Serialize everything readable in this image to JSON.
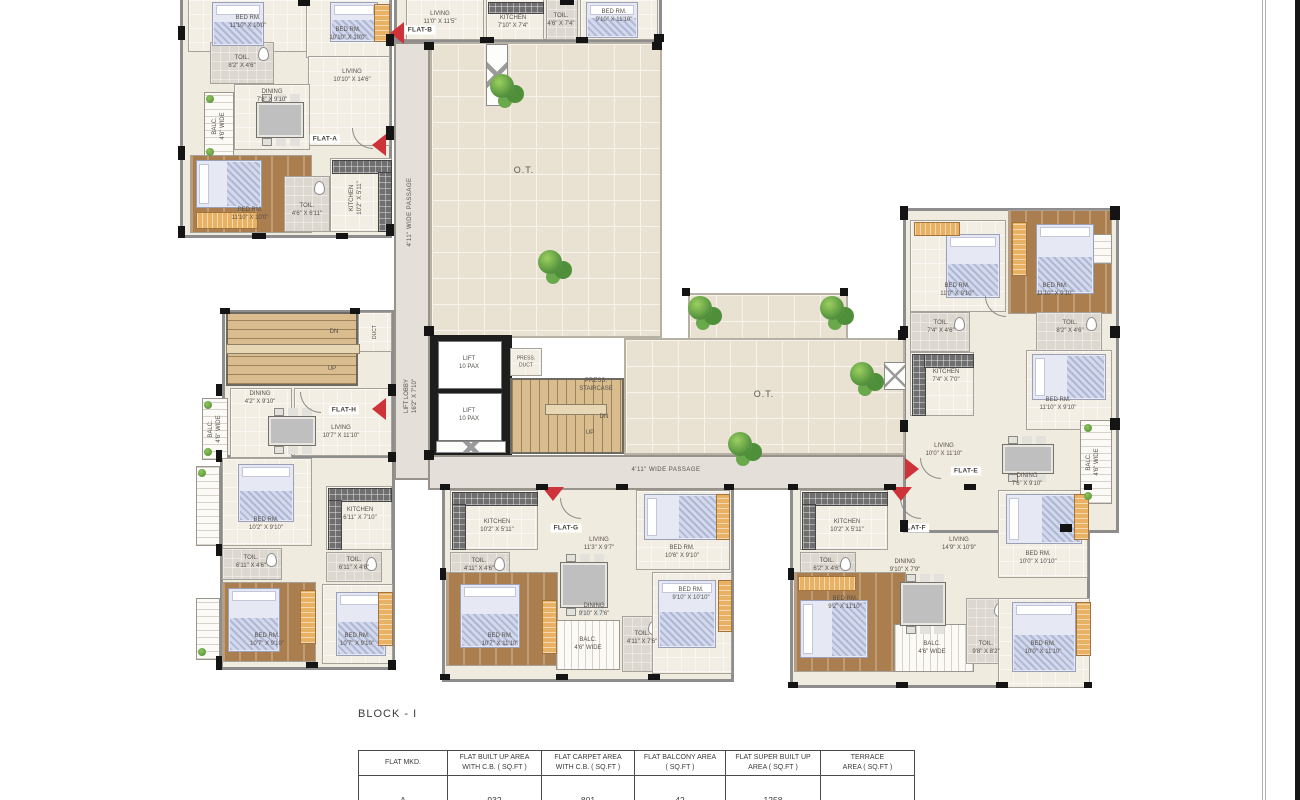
{
  "page": {
    "block_title": "BLOCK - I"
  },
  "table": {
    "headers": [
      "FLAT MKD.",
      "FLAT BUILT UP AREA\nWITH C.B. ( SQ.FT )",
      "FLAT CARPET AREA\nWITH C.B. ( SQ.FT )",
      "FLAT BALCONY AREA\n( SQ.FT )",
      "FLAT SUPER BUILT UP\nAREA ( SQ.FT )",
      "TERRACE\nAREA ( SQ.FT )"
    ],
    "row": [
      "A",
      "932",
      "801",
      "42",
      "1258",
      "-"
    ]
  },
  "common": {
    "ot": "O.T.",
    "passage": "4'11\" WIDE PASSAGE",
    "lift_lobby": "LIFT LOBBY\n16'2\" X 7'10\"",
    "lift": "LIFT\n10 PAX",
    "press_duct": "PRESS.\nDUCT",
    "press_stair": "PRESS.\nSTAIRCASE",
    "dn": "DN",
    "up": "UP",
    "duct": "DUCT"
  },
  "flats": {
    "a": {
      "label": "FLAT-A",
      "rooms": {
        "a1": {
          "n": "BED RM.",
          "d": "11'10\" X 10'0\""
        },
        "a2": {
          "n": "BED RM.",
          "d": "10'10\" X 10'0\""
        },
        "a3": {
          "n": "TOIL.",
          "d": "8'2\" X 4'6\""
        },
        "a4": {
          "n": "LIVING",
          "d": "10'10\" X 14'6\""
        },
        "a5": {
          "n": "DINING",
          "d": "7'8\" X 9'10\""
        },
        "a6": {
          "n": "BALC.",
          "d": "4'6\" WIDE"
        },
        "a7": {
          "n": "BED RM.",
          "d": "11'10\" X 10'0\""
        },
        "a8": {
          "n": "TOIL.",
          "d": "4'6\" X 6'11\""
        },
        "a9": {
          "n": "KITCHEN",
          "d": "10'2\" X 5'11\""
        }
      }
    },
    "b": {
      "label": "FLAT-B",
      "rooms": {
        "b1": {
          "n": "LIVING",
          "d": "11'0\" X 11'5\""
        },
        "b2": {
          "n": "KITCHEN",
          "d": "7'10\" X 7'4\""
        },
        "b3": {
          "n": "TOIL.",
          "d": "4'6\" X 7'4\""
        },
        "b4": {
          "n": "BED RM.",
          "d": "9'10\" X 11'10\""
        }
      }
    },
    "h": {
      "label": "FLAT-H",
      "rooms": {
        "h1": {
          "n": "DINING",
          "d": "4'2\" X 9'10\""
        },
        "h2": {
          "n": "LIVING",
          "d": "10'7\" X 11'10\""
        },
        "h3": {
          "n": "BALC.",
          "d": "4'6\" WIDE"
        },
        "h4": {
          "n": "BED RM.",
          "d": "10'2\" X 9'10\""
        },
        "h5": {
          "n": "TOIL.",
          "d": "6'11\" X 4'6\""
        },
        "h6": {
          "n": "BED RM.",
          "d": "10'7\" X 9'10\""
        },
        "h7": {
          "n": "KITCHEN",
          "d": "6'11\" X 7'10\""
        },
        "h8": {
          "n": "TOIL.",
          "d": "6'11\" X 4'6\""
        },
        "h9": {
          "n": "BED RM.",
          "d": "10'7\" X 9'10\""
        }
      }
    },
    "g": {
      "label": "FLAT-G",
      "rooms": {
        "g1": {
          "n": "KITCHEN",
          "d": "10'2\" X 5'11\""
        },
        "g2": {
          "n": "LIVING",
          "d": "11'3\" X 9'7\""
        },
        "g3": {
          "n": "BED RM.",
          "d": "10'6\" X 9'10\""
        },
        "g4": {
          "n": "TOIL.",
          "d": "4'11\" X 4'6\""
        },
        "g5": {
          "n": "BED RM.",
          "d": "10'7\" X 11'10\""
        },
        "g6": {
          "n": "DINING",
          "d": "9'10\" X 7'6\""
        },
        "g7": {
          "n": "BALC.",
          "d": "4'6\" WIDE"
        },
        "g8": {
          "n": "TOIL.",
          "d": "4'11\" X 7'6\""
        },
        "g9": {
          "n": "BED RM.",
          "d": "9'10\" X 10'10\""
        }
      }
    },
    "f": {
      "label": "FLAT-F",
      "rooms": {
        "f1": {
          "n": "KITCHEN",
          "d": "10'2\" X 5'11\""
        },
        "f2": {
          "n": "LIVING",
          "d": "14'9\" X 10'9\""
        },
        "f3": {
          "n": "DINING",
          "d": "9'10\" X 7'9\""
        },
        "f4": {
          "n": "TOIL.",
          "d": "6'2\" X 4'6\""
        },
        "f5": {
          "n": "BED RM.",
          "d": "9'2\" X 11'10\""
        },
        "f6": {
          "n": "BED RM.",
          "d": "10'0\" X 10'10\""
        },
        "f7": {
          "n": "BED RM.",
          "d": "10'0\" X 11'10\""
        },
        "f8": {
          "n": "TOIL.",
          "d": "9'8\" X 8'2\""
        },
        "f9": {
          "n": "BALC.",
          "d": "4'6\" WIDE"
        }
      }
    },
    "e": {
      "label": "FLAT-E",
      "rooms": {
        "e1": {
          "n": "BED RM.",
          "d": "11'0\" X 9'10\""
        },
        "e2": {
          "n": "BED RM.",
          "d": "11'10\" X 9'10\""
        },
        "e3": {
          "n": "TOIL.",
          "d": "7'4\" X 4'6\""
        },
        "e4": {
          "n": "TOIL.",
          "d": "8'2\" X 4'6\""
        },
        "e5": {
          "n": "KITCHEN",
          "d": "7'4\" X 7'0\""
        },
        "e6": {
          "n": "BED RM.",
          "d": "11'10\" X 9'10\""
        },
        "e7": {
          "n": "LIVING",
          "d": "10'0\" X 11'10\""
        },
        "e8": {
          "n": "DINING",
          "d": "7'6\" X 9'10\""
        },
        "e9": {
          "n": "BALC.",
          "d": "4'6\" WIDE"
        }
      }
    }
  }
}
